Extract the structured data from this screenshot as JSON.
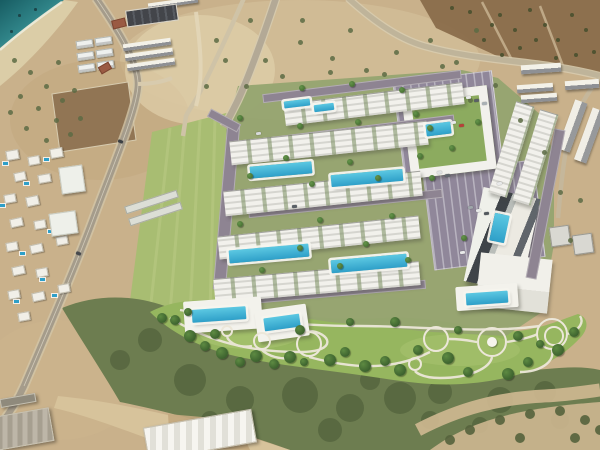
{
  "meta": {
    "view": "aerial-site-plan",
    "width": 600,
    "height": 450
  },
  "palette": {
    "dirt": "#c9b18b",
    "dirt_light": "#dccaa5",
    "brown_field": "#8a6d4b",
    "sea_deep": "#175c62",
    "sea_mid": "#2f8387",
    "sea_light": "#7cc0b8",
    "beach": "#dbcda7",
    "sand": "#d2bd95",
    "field_green": "#a8bd72",
    "lawn": "#96b65f",
    "scrub": "#6d7d50",
    "scrub_dark": "#4a5a36",
    "road": "#a59c8b",
    "rroad": "#8e8492",
    "park": "#90879a",
    "bld": "#f2f1ec",
    "deck": "#f3f2ec",
    "pool": "#2e9fc8",
    "tree1": "#3c612e",
    "tree2": "#5d8a42",
    "court": "#8cab5f",
    "path": "#ece7d9",
    "char": "#43454a",
    "red": "#9a5a43"
  },
  "scene": {
    "apartment_rows": [
      [
        284,
        93,
        180,
        22,
        -7
      ],
      [
        230,
        131,
        198,
        24,
        -6
      ],
      [
        224,
        181,
        198,
        25,
        -6
      ],
      [
        218,
        226,
        202,
        23,
        -6
      ],
      [
        214,
        270,
        206,
        24,
        -5
      ],
      [
        502,
        102,
        19,
        95,
        17
      ],
      [
        526,
        110,
        19,
        95,
        17
      ]
    ],
    "render_roads": [
      [
        220,
        124,
        13,
        166,
        5
      ],
      [
        262,
        82,
        200,
        9,
        -7
      ],
      [
        250,
        127,
        205,
        9,
        -7
      ],
      [
        248,
        199,
        195,
        9,
        -6
      ],
      [
        236,
        288,
        190,
        9,
        -5
      ],
      [
        540,
        128,
        11,
        152,
        11
      ],
      [
        207,
        116,
        34,
        9,
        28
      ]
    ],
    "parking_lots": [
      [
        398,
        76,
        100,
        96,
        -7
      ],
      [
        428,
        166,
        112,
        98,
        -7
      ]
    ],
    "complexes": {
      "courtyard_block": [
        406,
        90,
        86,
        84,
        -7
      ],
      "tower_block": [
        473,
        192,
        58,
        96,
        12
      ],
      "south_block": [
        478,
        256,
        72,
        54,
        6
      ]
    },
    "pools": [
      [
        250,
        164,
        62,
        12,
        -5
      ],
      [
        331,
        172,
        72,
        12,
        -5
      ],
      [
        229,
        247,
        80,
        13,
        -5
      ],
      [
        331,
        257,
        76,
        13,
        -5
      ],
      [
        284,
        100,
        26,
        7,
        -7
      ],
      [
        314,
        104,
        20,
        7,
        -7
      ],
      [
        426,
        123,
        25,
        12,
        -7
      ],
      [
        492,
        214,
        15,
        28,
        12
      ],
      [
        466,
        292,
        42,
        12,
        -4
      ],
      [
        192,
        308,
        54,
        13,
        -4
      ],
      [
        264,
        316,
        36,
        13,
        -8
      ]
    ],
    "decks": [
      [
        184,
        299,
        78,
        32,
        -4
      ],
      [
        256,
        307,
        52,
        32,
        -8
      ],
      [
        456,
        285,
        62,
        24,
        -4
      ]
    ],
    "plazas": [
      [
        262,
        341,
        9,
        ""
      ],
      [
        309,
        344,
        13,
        ""
      ],
      [
        436,
        339,
        13,
        ""
      ],
      [
        492,
        342,
        15,
        "gazebo"
      ],
      [
        552,
        334,
        16,
        "double"
      ],
      [
        415,
        364,
        7,
        ""
      ],
      [
        227,
        331,
        6,
        ""
      ]
    ],
    "villas": [
      [
        6,
        150,
        13,
        10,
        -10
      ],
      [
        28,
        156,
        12,
        9,
        -10
      ],
      [
        50,
        148,
        13,
        10,
        -10
      ],
      [
        14,
        172,
        12,
        9,
        -12
      ],
      [
        38,
        174,
        13,
        9,
        -10
      ],
      [
        4,
        194,
        12,
        9,
        -10
      ],
      [
        26,
        196,
        13,
        10,
        -12
      ],
      [
        10,
        218,
        13,
        9,
        -12
      ],
      [
        34,
        220,
        12,
        9,
        -10
      ],
      [
        6,
        242,
        12,
        9,
        -10
      ],
      [
        30,
        244,
        13,
        9,
        -12
      ],
      [
        56,
        236,
        12,
        9,
        -10
      ],
      [
        12,
        266,
        13,
        9,
        -12
      ],
      [
        36,
        268,
        12,
        9,
        -10
      ],
      [
        8,
        290,
        12,
        9,
        -10
      ],
      [
        32,
        292,
        13,
        9,
        -12
      ],
      [
        58,
        284,
        12,
        9,
        -10
      ],
      [
        18,
        312,
        12,
        9,
        -10
      ]
    ],
    "villa_pools": [
      [
        3,
        162
      ],
      [
        44,
        158
      ],
      [
        24,
        182
      ],
      [
        0,
        204
      ],
      [
        48,
        230
      ],
      [
        20,
        252
      ],
      [
        40,
        278
      ],
      [
        14,
        300
      ],
      [
        52,
        294
      ]
    ],
    "villa_big_roofs": [
      [
        60,
        166,
        24,
        27,
        -8
      ],
      [
        50,
        212,
        27,
        23,
        -8
      ]
    ],
    "greenhouses": [
      [
        124,
        198,
        55,
        8,
        -18
      ],
      [
        128,
        210,
        55,
        8,
        -18
      ]
    ],
    "warehouses": [
      [
        145,
        418,
        110,
        34,
        -10,
        "wh"
      ],
      [
        -6,
        412,
        58,
        34,
        -10,
        "wh gray"
      ],
      [
        0,
        396,
        36,
        9,
        -10,
        "wh dark"
      ]
    ],
    "construction_units": [
      [
        76,
        40,
        17,
        8,
        -8
      ],
      [
        95,
        37,
        17,
        8,
        -8
      ],
      [
        77,
        52,
        17,
        8,
        -8
      ],
      [
        96,
        49,
        17,
        8,
        -8
      ],
      [
        78,
        64,
        17,
        8,
        -8
      ],
      [
        97,
        61,
        17,
        8,
        -8
      ]
    ],
    "construction_rows": [
      [
        123,
        41,
        48,
        7,
        -8
      ],
      [
        125,
        51,
        48,
        7,
        -8
      ],
      [
        127,
        61,
        48,
        7,
        -8
      ],
      [
        148,
        0,
        50,
        6,
        -8
      ]
    ],
    "charcoal_building": [
      126,
      7,
      52,
      17,
      -8
    ],
    "red_roof_houses": [
      [
        112,
        19,
        14,
        9,
        -14
      ],
      [
        99,
        64,
        12,
        8,
        -30
      ]
    ],
    "construction_rows_ne": [
      [
        521,
        64,
        40,
        9,
        -4
      ],
      [
        517,
        84,
        36,
        8,
        -4
      ],
      [
        521,
        94,
        36,
        8,
        -4
      ],
      [
        565,
        80,
        34,
        9,
        -4
      ]
    ],
    "construction_rows_e": [
      [
        566,
        100,
        13,
        52,
        20
      ],
      [
        583,
        108,
        13,
        55,
        20
      ]
    ],
    "construction_blocks_e": [
      [
        550,
        226,
        20,
        20,
        -8
      ],
      [
        573,
        234,
        20,
        20,
        -8
      ]
    ],
    "trees_park": [
      [
        175,
        320,
        5
      ],
      [
        190,
        336,
        6
      ],
      [
        205,
        346,
        5
      ],
      [
        222,
        353,
        6
      ],
      [
        240,
        362,
        5
      ],
      [
        256,
        356,
        6
      ],
      [
        274,
        364,
        5
      ],
      [
        290,
        357,
        6
      ],
      [
        304,
        362,
        4
      ],
      [
        330,
        360,
        6
      ],
      [
        345,
        352,
        5
      ],
      [
        365,
        366,
        6
      ],
      [
        385,
        361,
        5
      ],
      [
        400,
        370,
        6
      ],
      [
        418,
        350,
        5
      ],
      [
        448,
        358,
        6
      ],
      [
        468,
        372,
        5
      ],
      [
        508,
        374,
        6
      ],
      [
        528,
        362,
        5
      ],
      [
        558,
        350,
        6
      ],
      [
        574,
        332,
        5
      ],
      [
        300,
        330,
        5
      ],
      [
        350,
        322,
        4
      ],
      [
        395,
        322,
        5
      ],
      [
        458,
        330,
        4
      ],
      [
        518,
        336,
        5
      ],
      [
        540,
        344,
        4
      ],
      [
        215,
        334,
        5
      ],
      [
        188,
        312,
        4
      ],
      [
        162,
        318,
        5
      ]
    ],
    "trees_dev": [
      [
        240,
        118
      ],
      [
        300,
        126
      ],
      [
        358,
        122
      ],
      [
        416,
        114
      ],
      [
        250,
        176
      ],
      [
        312,
        184
      ],
      [
        378,
        178
      ],
      [
        240,
        224
      ],
      [
        320,
        220
      ],
      [
        392,
        216
      ],
      [
        262,
        270
      ],
      [
        340,
        266
      ],
      [
        408,
        260
      ],
      [
        432,
        178
      ],
      [
        452,
        148
      ],
      [
        464,
        238
      ],
      [
        302,
        88
      ],
      [
        352,
        84
      ],
      [
        402,
        90
      ],
      [
        286,
        158
      ],
      [
        350,
        162
      ],
      [
        420,
        156
      ],
      [
        300,
        248
      ],
      [
        366,
        244
      ],
      [
        430,
        128
      ],
      [
        478,
        122
      ]
    ],
    "shrubs_dirt": [
      [
        265,
        60
      ],
      [
        300,
        42
      ],
      [
        332,
        58
      ],
      [
        366,
        70
      ],
      [
        396,
        52
      ],
      [
        430,
        40
      ],
      [
        456,
        62
      ],
      [
        476,
        30
      ],
      [
        302,
        20
      ],
      [
        350,
        30
      ],
      [
        246,
        86
      ],
      [
        216,
        40
      ],
      [
        206,
        86
      ],
      [
        282,
        76
      ],
      [
        330,
        72
      ],
      [
        384,
        74
      ],
      [
        442,
        66
      ],
      [
        520,
        120
      ],
      [
        544,
        152
      ],
      [
        560,
        192
      ],
      [
        570,
        240
      ],
      [
        580,
        200
      ],
      [
        250,
        20
      ],
      [
        225,
        60
      ],
      [
        495,
        85
      ],
      [
        470,
        100
      ]
    ],
    "dots_field_ne": [
      [
        500,
        15
      ],
      [
        515,
        30
      ],
      [
        530,
        10
      ],
      [
        545,
        25
      ],
      [
        558,
        40
      ],
      [
        572,
        15
      ],
      [
        586,
        30
      ],
      [
        594,
        52
      ],
      [
        520,
        48
      ],
      [
        502,
        55
      ],
      [
        484,
        40
      ],
      [
        556,
        58
      ],
      [
        576,
        55
      ],
      [
        492,
        25
      ],
      [
        536,
        40
      ],
      [
        470,
        12
      ],
      [
        452,
        8
      ]
    ],
    "shrubs_coast": [
      [
        14,
        60
      ],
      [
        30,
        72
      ],
      [
        46,
        86
      ],
      [
        20,
        96
      ],
      [
        38,
        108
      ],
      [
        56,
        120
      ],
      [
        26,
        128
      ],
      [
        46,
        140
      ],
      [
        62,
        100
      ],
      [
        70,
        134
      ],
      [
        10,
        112
      ],
      [
        58,
        62
      ],
      [
        74,
        90
      ],
      [
        80,
        118
      ]
    ],
    "bushes_se": [
      [
        470,
        430
      ],
      [
        500,
        420
      ],
      [
        530,
        414
      ],
      [
        560,
        411
      ],
      [
        585,
        420
      ],
      [
        450,
        440
      ],
      [
        520,
        438
      ],
      [
        575,
        438
      ],
      [
        600,
        430
      ]
    ],
    "cars": [
      [
        466,
        96,
        -7,
        "#e9eaea"
      ],
      [
        474,
        99,
        -7,
        "#5a6066"
      ],
      [
        482,
        102,
        -7,
        "#aab1b5"
      ],
      [
        451,
        121,
        -7,
        "#e9eaea"
      ],
      [
        459,
        124,
        -7,
        "#b7413a"
      ],
      [
        437,
        171,
        -7,
        "#dfe1e1"
      ],
      [
        445,
        174,
        -7,
        "#62686e"
      ],
      [
        497,
        182,
        -7,
        "#e9eaea"
      ],
      [
        468,
        206,
        -7,
        "#9fa6aa"
      ],
      [
        476,
        209,
        -7,
        "#e9eaea"
      ],
      [
        484,
        212,
        -7,
        "#52585e"
      ],
      [
        460,
        251,
        -7,
        "#e9eaea"
      ],
      [
        256,
        132,
        -7,
        "#d8dadb"
      ],
      [
        292,
        205,
        -6,
        "#5a6066"
      ],
      [
        118,
        140,
        20,
        "#3c4044"
      ],
      [
        76,
        252,
        22,
        "#46494d"
      ]
    ],
    "buoys": [
      [
        18,
        14
      ],
      [
        34,
        8
      ],
      [
        10,
        30
      ]
    ]
  }
}
